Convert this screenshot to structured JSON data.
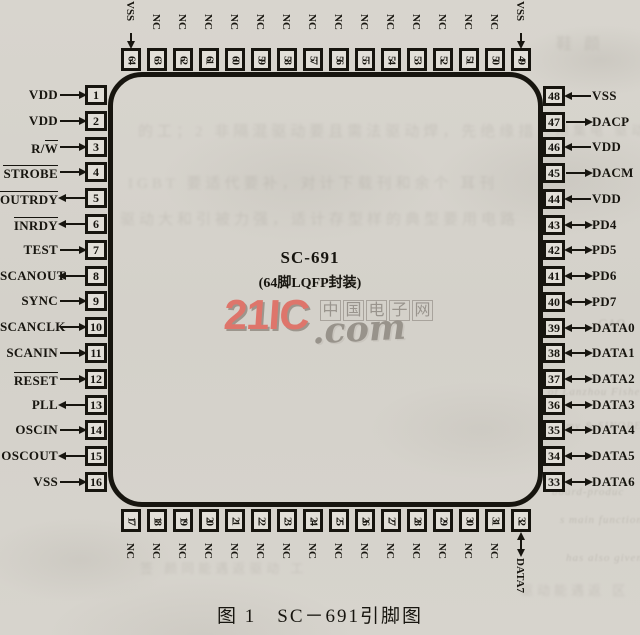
{
  "figure": {
    "caption": "图 1　SC－691引脚图"
  },
  "chip": {
    "name": "SC-691",
    "package": "(64脚LQFP封装)"
  },
  "watermark": {
    "brand": "21IC",
    "com": ".com",
    "site_name": "中国电子网",
    "brand_color": "#df6e63",
    "gray_color": "#8f8a83"
  },
  "colors": {
    "paper": "#d6d3cc",
    "ink": "#17150f"
  },
  "pins": {
    "left": [
      {
        "num": 1,
        "label": "VDD",
        "dir": "in",
        "overline": "none"
      },
      {
        "num": 2,
        "label": "VDD",
        "dir": "in",
        "overline": "none"
      },
      {
        "num": 3,
        "label": "R/W",
        "dir": "in",
        "overline": "W"
      },
      {
        "num": 4,
        "label": "STROBE",
        "dir": "in",
        "overline": "full"
      },
      {
        "num": 5,
        "label": "OUTRDY",
        "dir": "out",
        "overline": "full"
      },
      {
        "num": 6,
        "label": "INRDY",
        "dir": "out",
        "overline": "full"
      },
      {
        "num": 7,
        "label": "TEST",
        "dir": "in",
        "overline": "none"
      },
      {
        "num": 8,
        "label": "SCANOUT",
        "dir": "out",
        "overline": "none"
      },
      {
        "num": 9,
        "label": "SYNC",
        "dir": "in",
        "overline": "none"
      },
      {
        "num": 10,
        "label": "SCANCLK",
        "dir": "in",
        "overline": "none"
      },
      {
        "num": 11,
        "label": "SCANIN",
        "dir": "in",
        "overline": "none"
      },
      {
        "num": 12,
        "label": "RESET",
        "dir": "in",
        "overline": "full"
      },
      {
        "num": 13,
        "label": "PLL",
        "dir": "out",
        "overline": "none"
      },
      {
        "num": 14,
        "label": "OSCIN",
        "dir": "in",
        "overline": "none"
      },
      {
        "num": 15,
        "label": "OSCOUT",
        "dir": "out",
        "overline": "none"
      },
      {
        "num": 16,
        "label": "VSS",
        "dir": "in",
        "overline": "none"
      }
    ],
    "right": [
      {
        "num": 48,
        "label": "VSS",
        "dir": "in",
        "overline": "none"
      },
      {
        "num": 47,
        "label": "DACP",
        "dir": "out",
        "overline": "none"
      },
      {
        "num": 46,
        "label": "VDD",
        "dir": "in",
        "overline": "none"
      },
      {
        "num": 45,
        "label": "DACM",
        "dir": "out",
        "overline": "none"
      },
      {
        "num": 44,
        "label": "VDD",
        "dir": "in",
        "overline": "none"
      },
      {
        "num": 43,
        "label": "PD4",
        "dir": "bi",
        "overline": "none"
      },
      {
        "num": 42,
        "label": "PD5",
        "dir": "bi",
        "overline": "none"
      },
      {
        "num": 41,
        "label": "PD6",
        "dir": "bi",
        "overline": "none"
      },
      {
        "num": 40,
        "label": "PD7",
        "dir": "bi",
        "overline": "none"
      },
      {
        "num": 39,
        "label": "DATA0",
        "dir": "bi",
        "overline": "none"
      },
      {
        "num": 38,
        "label": "DATA1",
        "dir": "bi",
        "overline": "none"
      },
      {
        "num": 37,
        "label": "DATA2",
        "dir": "bi",
        "overline": "none"
      },
      {
        "num": 36,
        "label": "DATA3",
        "dir": "bi",
        "overline": "none"
      },
      {
        "num": 35,
        "label": "DATA4",
        "dir": "bi",
        "overline": "none"
      },
      {
        "num": 34,
        "label": "DATA5",
        "dir": "bi",
        "overline": "none"
      },
      {
        "num": 33,
        "label": "DATA6",
        "dir": "bi",
        "overline": "none"
      }
    ],
    "top": [
      {
        "num": 64,
        "label": "VSS",
        "dir": "in",
        "overline": "none"
      },
      {
        "num": 63,
        "label": "NC",
        "dir": "none",
        "overline": "none"
      },
      {
        "num": 62,
        "label": "NC",
        "dir": "none",
        "overline": "none"
      },
      {
        "num": 61,
        "label": "NC",
        "dir": "none",
        "overline": "none"
      },
      {
        "num": 60,
        "label": "NC",
        "dir": "none",
        "overline": "none"
      },
      {
        "num": 59,
        "label": "NC",
        "dir": "none",
        "overline": "none"
      },
      {
        "num": 58,
        "label": "NC",
        "dir": "none",
        "overline": "none"
      },
      {
        "num": 57,
        "label": "NC",
        "dir": "none",
        "overline": "none"
      },
      {
        "num": 56,
        "label": "NC",
        "dir": "none",
        "overline": "none"
      },
      {
        "num": 55,
        "label": "NC",
        "dir": "none",
        "overline": "none"
      },
      {
        "num": 54,
        "label": "NC",
        "dir": "none",
        "overline": "none"
      },
      {
        "num": 53,
        "label": "NC",
        "dir": "none",
        "overline": "none"
      },
      {
        "num": 52,
        "label": "NC",
        "dir": "none",
        "overline": "none"
      },
      {
        "num": 51,
        "label": "NC",
        "dir": "none",
        "overline": "none"
      },
      {
        "num": 50,
        "label": "NC",
        "dir": "none",
        "overline": "none"
      },
      {
        "num": 49,
        "label": "VSS",
        "dir": "in",
        "overline": "none"
      }
    ],
    "bottom": [
      {
        "num": 17,
        "label": "NC",
        "dir": "none",
        "overline": "none"
      },
      {
        "num": 18,
        "label": "NC",
        "dir": "none",
        "overline": "none"
      },
      {
        "num": 19,
        "label": "NC",
        "dir": "none",
        "overline": "none"
      },
      {
        "num": 20,
        "label": "NC",
        "dir": "none",
        "overline": "none"
      },
      {
        "num": 21,
        "label": "NC",
        "dir": "none",
        "overline": "none"
      },
      {
        "num": 22,
        "label": "NC",
        "dir": "none",
        "overline": "none"
      },
      {
        "num": 23,
        "label": "NC",
        "dir": "none",
        "overline": "none"
      },
      {
        "num": 24,
        "label": "NC",
        "dir": "none",
        "overline": "none"
      },
      {
        "num": 25,
        "label": "NC",
        "dir": "none",
        "overline": "none"
      },
      {
        "num": 26,
        "label": "NC",
        "dir": "none",
        "overline": "none"
      },
      {
        "num": 27,
        "label": "NC",
        "dir": "none",
        "overline": "none"
      },
      {
        "num": 28,
        "label": "NC",
        "dir": "none",
        "overline": "none"
      },
      {
        "num": 29,
        "label": "NC",
        "dir": "none",
        "overline": "none"
      },
      {
        "num": 30,
        "label": "NC",
        "dir": "none",
        "overline": "none"
      },
      {
        "num": 31,
        "label": "NC",
        "dir": "none",
        "overline": "none"
      },
      {
        "num": 32,
        "label": "DATA7",
        "dir": "bi",
        "overline": "none"
      }
    ]
  },
  "ghost_texts": {
    "cjk_lines": [
      {
        "x": 138,
        "y": 120,
        "size": 15,
        "text": "的工；2 非隔混驱动要且需法驱动焊，先绝缘措"
      },
      {
        "x": 128,
        "y": 172,
        "size": 15,
        "text": "IGBT 要适代要补，对计下载刊和余个 耳刊"
      },
      {
        "x": 120,
        "y": 208,
        "size": 15,
        "text": "驱动大和引被力强，适计存型样的典型要用电路"
      },
      {
        "x": 556,
        "y": 30,
        "size": 16,
        "text": "鞋 颜"
      },
      {
        "x": 556,
        "y": 120,
        "size": 13,
        "text": "用集电 驱动"
      },
      {
        "x": 140,
        "y": 558,
        "size": 13,
        "text": "签 颜同能遇返驱动 工"
      },
      {
        "x": 520,
        "y": 580,
        "size": 13,
        "text": "驱动能遇返 区"
      }
    ],
    "english_fragments": [
      {
        "x": 598,
        "y": 316,
        "size": 12,
        "text": "GAO"
      },
      {
        "x": 548,
        "y": 386,
        "size": 11,
        "text": "of Lanzhou Fisher Polytech"
      },
      {
        "x": 566,
        "y": 420,
        "size": 11,
        "text": "my & SINOPE"
      },
      {
        "x": 552,
        "y": 486,
        "size": 11,
        "text": "board-produc"
      },
      {
        "x": 560,
        "y": 514,
        "size": 11,
        "text": "s main functions"
      },
      {
        "x": 566,
        "y": 552,
        "size": 11,
        "text": "has also given"
      }
    ]
  }
}
